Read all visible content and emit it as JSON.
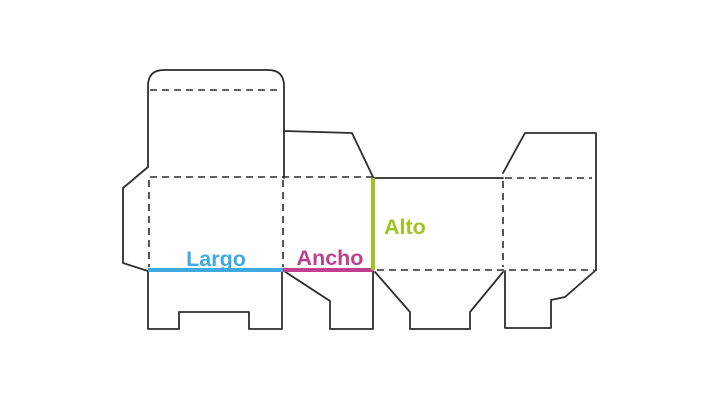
{
  "diagram": {
    "name": "box-dieline-template",
    "background": "#ffffff",
    "outline_color": "#2d2d2d",
    "labels": {
      "largo": {
        "text": "Largo",
        "color": "#3FA9E1"
      },
      "ancho": {
        "text": "Ancho",
        "color": "#C0408F"
      },
      "alto": {
        "text": "Alto",
        "color": "#9EC51F"
      }
    }
  }
}
